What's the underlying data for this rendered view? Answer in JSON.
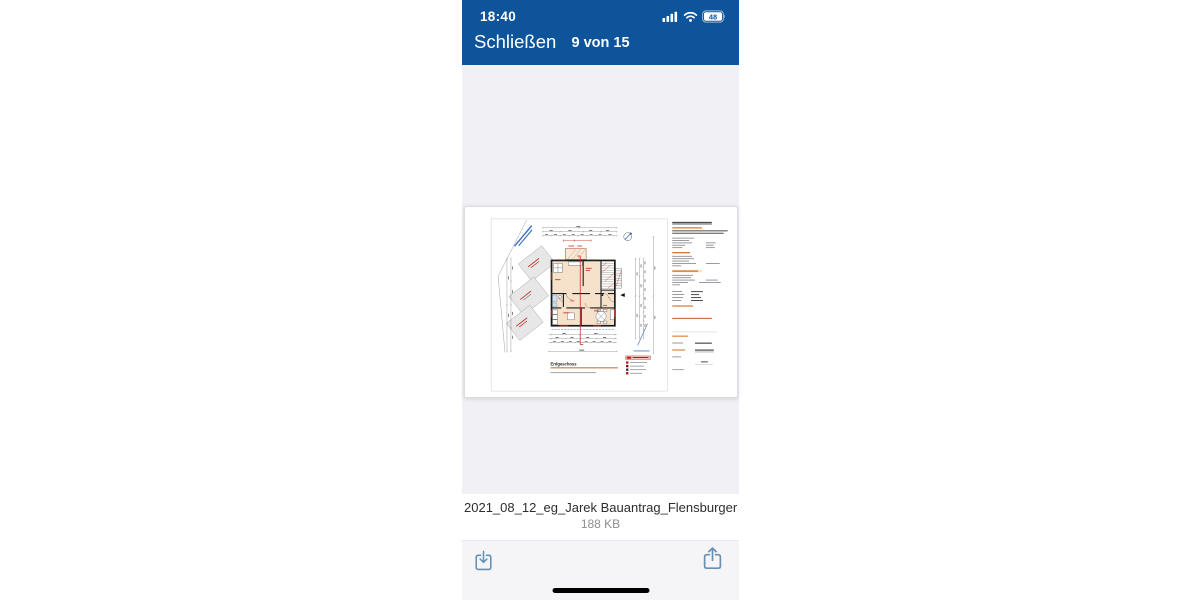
{
  "status_bar": {
    "time": "18:40",
    "battery_level": "48"
  },
  "nav_bar": {
    "close_label": "Schließen",
    "page_indicator": "9 von 15"
  },
  "document_preview": {
    "drawing_title": "Erdgeschoss"
  },
  "file_info": {
    "name": "2021_08_12_eg_Jarek Bauantrag_Flensburger Str 4 in Soli…",
    "size": "188 KB"
  },
  "toolbar": {
    "download_icon": "square-and-arrow-down",
    "share_icon": "square-and-arrow-up"
  },
  "colors": {
    "header_blue": "#0d549b",
    "viewer_bg": "#f0f0f5",
    "toolbar_bg": "#f5f5f7",
    "icon_blue": "#6690b6",
    "plan_room_fill": "#f6e2cb",
    "accent_red": "#c0392b",
    "accent_orange": "#d4691e",
    "home_indicator": "#000000"
  }
}
